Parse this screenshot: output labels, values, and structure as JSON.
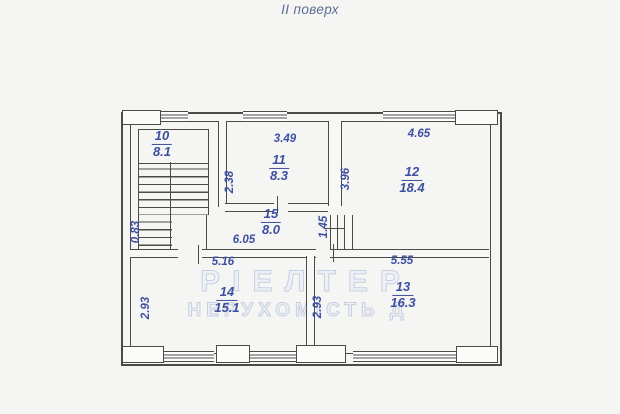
{
  "title": "II поверх",
  "watermark": {
    "line1": "РІЕЛТЕР",
    "line2": "НЕРУХОМІСТЬ Д"
  },
  "rooms": [
    {
      "id": "10",
      "area": "8.1"
    },
    {
      "id": "11",
      "area": "8.3"
    },
    {
      "id": "12",
      "area": "18.4"
    },
    {
      "id": "13",
      "area": "16.3"
    },
    {
      "id": "14",
      "area": "15.1"
    },
    {
      "id": "15",
      "area": "8.0"
    }
  ],
  "dims": {
    "room11_width": "3.49",
    "room11_depth": "2.38",
    "room12_width": "4.65",
    "room12_depth": "3.96",
    "hall_width": "6.05",
    "hall_end": "1.45",
    "stair_width": "0.83",
    "room14_width": "5.16",
    "room14_depth": "2.93",
    "room13_width": "5.55",
    "room13_depth": "2.93"
  }
}
